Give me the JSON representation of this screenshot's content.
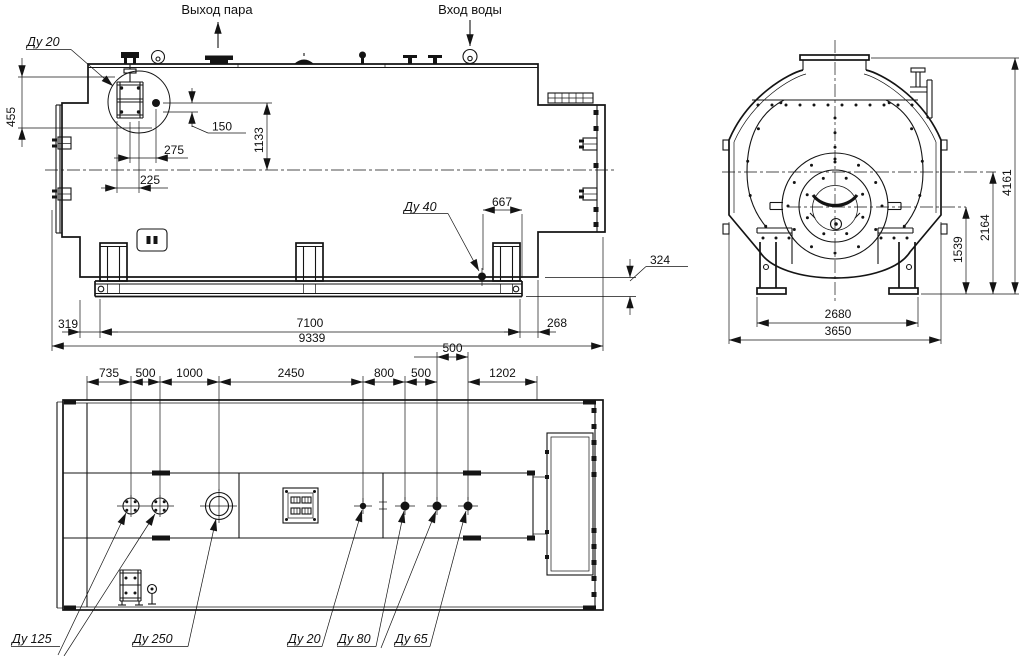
{
  "drawing": {
    "annotations": {
      "steam_outlet": "Выход пара",
      "water_inlet": "Вход воды"
    },
    "side_view": {
      "callouts": {
        "du20": "Ду 20",
        "du40": "Ду 40"
      },
      "dims": {
        "d455": "455",
        "d150": "150",
        "d1133": "1133",
        "d275": "275",
        "d225": "225",
        "d667": "667",
        "d324": "324",
        "d319": "319",
        "d7100": "7100",
        "d268": "268",
        "d9339": "9339"
      }
    },
    "front_view": {
      "dims": {
        "d4161": "4161",
        "d2164": "2164",
        "d1539": "1539",
        "d2680": "2680",
        "d3650": "3650"
      }
    },
    "plan_view": {
      "dims": {
        "d735": "735",
        "d500a": "500",
        "d1000": "1000",
        "d2450": "2450",
        "d800": "800",
        "d500b": "500",
        "d500c": "500",
        "d1202": "1202"
      },
      "callouts": {
        "du125": "Ду 125",
        "du250": "Ду 250",
        "du20": "Ду 20",
        "du80": "Ду 80",
        "du65": "Ду 65"
      }
    }
  }
}
